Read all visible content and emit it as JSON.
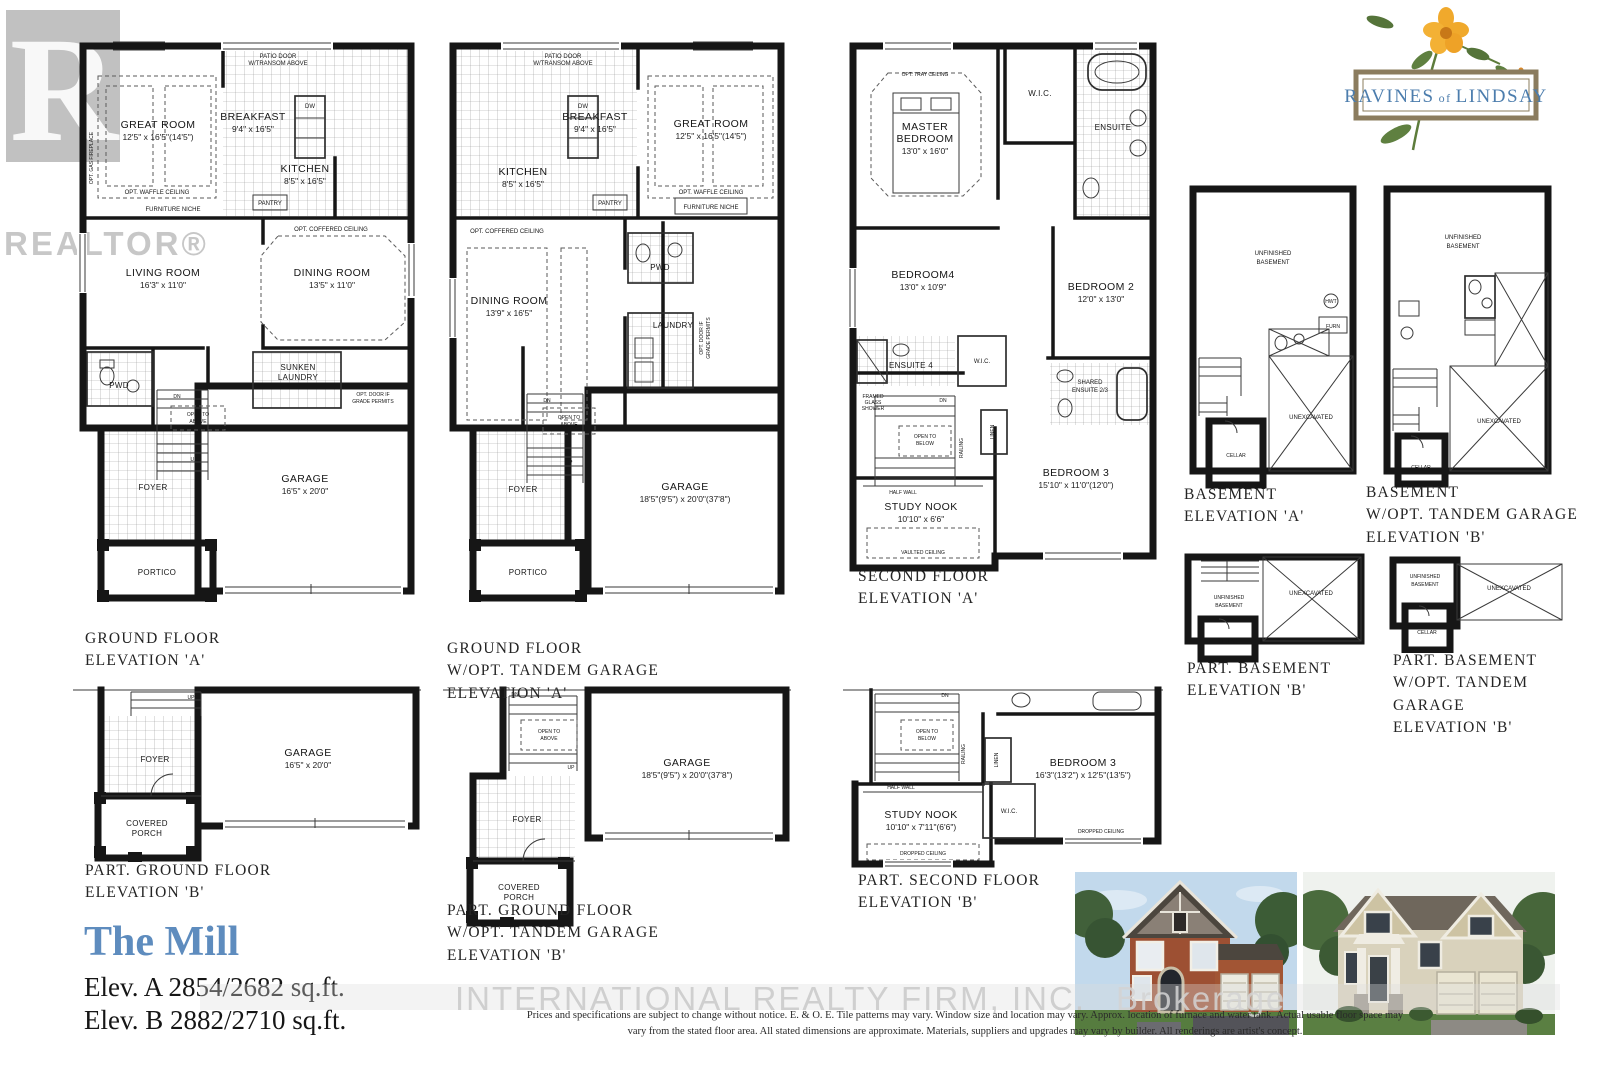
{
  "branding": {
    "realtor": "REALTOR®",
    "community": {
      "a": "RAVINES",
      "b": "of",
      "c": "LINDSAY"
    },
    "watermark_main": "INTERNATIONAL REALTY FIRM, INC.",
    "watermark_sub": "Brokerage"
  },
  "model": {
    "name": "The Mill",
    "elev_a": "Elev. A 2854/2682 sq.ft.",
    "elev_b": "Elev. B 2882/2710 sq.ft."
  },
  "disclaimer": {
    "line1": "Prices and specifications are subject to change without notice. E. & O. E. Tile patterns may vary. Window size and location may vary. Approx. location of furnace and water tank. Actual usable floor space may",
    "line2": "vary from the stated floor area. All stated dimensions are approximate. Materials, suppliers and upgrades may vary by builder. All renderings are artist's concept."
  },
  "titles": {
    "ground_a": [
      "GROUND FLOOR",
      "ELEVATION 'A'"
    ],
    "ground_tandem_a": [
      "GROUND FLOOR",
      "W/OPT. TANDEM GARAGE",
      "ELEVATION 'A'"
    ],
    "second_a": [
      "SECOND FLOOR",
      "ELEVATION 'A'"
    ],
    "basement_a": [
      "BASEMENT",
      "ELEVATION 'A'"
    ],
    "basement_tandem_b": [
      "BASEMENT",
      "W/OPT. TANDEM GARAGE",
      "ELEVATION 'B'"
    ],
    "part_basement_b": [
      "PART. BASEMENT",
      "ELEVATION 'B'"
    ],
    "part_basement_tandem_b": [
      "PART. BASEMENT",
      "W/OPT. TANDEM GARAGE",
      "ELEVATION 'B'"
    ],
    "part_ground_b": [
      "PART. GROUND FLOOR",
      "ELEVATION 'B'"
    ],
    "part_ground_tandem_b": [
      "PART. GROUND FLOOR",
      "W/OPT. TANDEM GARAGE",
      "ELEVATION 'B'"
    ],
    "part_second_b": [
      "PART. SECOND FLOOR",
      "ELEVATION 'B'"
    ]
  },
  "common": {
    "dn": "DN",
    "up": "UP",
    "open_to": "OPEN TO",
    "above": "ABOVE",
    "below": "BELOW",
    "patio1": "PATIO DOOR",
    "patio2": "W/TRANSOM ABOVE",
    "waffle": "OPT. WAFFLE CEILING",
    "niche": "FURNITURE NICHE",
    "coffered": "OPT. COFFERED CEILING",
    "pantry": "PANTRY",
    "dw": "DW",
    "optdoor1": "OPT. DOOR IF",
    "optdoor2": "GRADE PERMITS",
    "fireplace": "OPT. GAS FIREPLACE",
    "unfinished1": "UNFINISHED",
    "unfinished2": "BASEMENT",
    "unexcavated": "UNEXCAVATED",
    "cellar": "CELLAR",
    "half_wall": "HALF WALL",
    "dropped": "DROPPED CEILING",
    "vaulted": "VAULTED CEILING",
    "linen": "LINEN",
    "railing": "RAILING",
    "tray": "OPT. TRAY CEILING",
    "framed1": "FRAMED",
    "framed2": "GLASS",
    "framed3": "SHOWER",
    "hwt": "HWT",
    "furn": "FURN"
  },
  "rooms": {
    "p1": {
      "great": "GREAT ROOM",
      "great_d": "12'5\" x 16'5\"(14'5\")",
      "breakfast": "BREAKFAST",
      "breakfast_d": "9'4\" x 16'5\"",
      "kitchen": "KITCHEN",
      "kitchen_d": "8'5\" x 16'5\"",
      "living": "LIVING ROOM",
      "living_d": "16'3\" x 11'0\"",
      "dining": "DINING ROOM",
      "dining_d": "13'5\" x 11'0\"",
      "pwd": "PWD",
      "sunken1": "SUNKEN",
      "sunken2": "LAUNDRY",
      "foyer": "FOYER",
      "portico": "PORTICO",
      "garage": "GARAGE",
      "garage_d": "16'5\" x 20'0\""
    },
    "p2": {
      "breakfast": "BREAKFAST",
      "breakfast_d": "9'4\" x 16'5\"",
      "great": "GREAT ROOM",
      "great_d": "12'5\" x 16'5\"(14'5\")",
      "kitchen": "KITCHEN",
      "kitchen_d": "8'5\" x 16'5\"",
      "dining": "DINING ROOM",
      "dining_d": "13'9\" x 16'5\"",
      "pwd": "PWD",
      "laundry": "LAUNDRY",
      "foyer": "FOYER",
      "portico": "PORTICO",
      "garage": "GARAGE",
      "garage_d": "18'5\"(9'5\") x 20'0\"(37'8\")"
    },
    "p3": {
      "master1": "MASTER",
      "master2": "BEDROOM",
      "master_d": "13'0\" x 16'0\"",
      "wic": "W.I.C.",
      "ensuite": "ENSUITE",
      "bed4": "BEDROOM4",
      "bed4_d": "13'0\" x 10'9\"",
      "bed2": "BEDROOM 2",
      "bed2_d": "12'0\" x 13'0\"",
      "ensuite4": "ENSUITE 4",
      "wic2": "W.I.C.",
      "shared1": "SHARED",
      "shared2": "ENSUITE 2/3",
      "bed3": "BEDROOM 3",
      "bed3_d": "15'10\" x 11'0\"(12'0\")",
      "study": "STUDY NOOK",
      "study_d": "10'10\" x 6'6\""
    },
    "p8": {
      "foyer": "FOYER",
      "porch1": "COVERED",
      "porch2": "PORCH",
      "garage": "GARAGE",
      "garage_d": "16'5\" x 20'0\""
    },
    "p9": {
      "foyer": "FOYER",
      "porch1": "COVERED",
      "porch2": "PORCH",
      "garage": "GARAGE",
      "garage_d": "18'5\"(9'5\") x 20'0\"(37'8\")"
    },
    "p10": {
      "study": "STUDY NOOK",
      "study_d": "10'10\" x 7'11\"(6'6\")",
      "wic": "W.I.C.",
      "bed3": "BEDROOM 3",
      "bed3_d": "16'3\"(13'2\") x 12'5\"(13'5\")"
    }
  }
}
